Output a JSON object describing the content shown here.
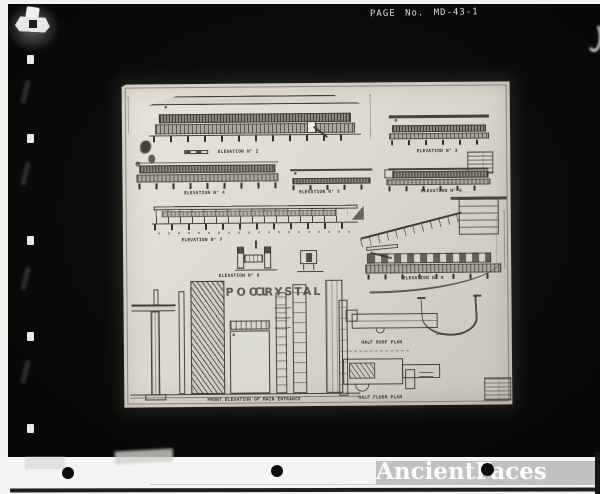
{
  "scan": {
    "handwritten_note": "PAGE No. MD-43-1",
    "watermark_text": "AncientFaces"
  },
  "sheet": {
    "sign_line1": "CRYSTAL",
    "sign_line2": "POOL",
    "labels": {
      "elevation2": "ELEVATION N° 2",
      "elevation3": "ELEVATION N° 3",
      "elevation4": "ELEVATION N° 4",
      "elevation5": "ELEVATION N° 5",
      "elevation6": "ELEVATION N° 6",
      "elevation7": "ELEVATION N° 7",
      "elevation8": "ELEVATION N° 8",
      "elevation9": "ELEVATION N° 9",
      "half_roof_plan": "HALF ROOF PLAN",
      "half_floor_plan": "HALF FLOOR PLAN",
      "entrance_caption": "FRONT ELEVATION OF MAIN ENTRANCE"
    }
  },
  "colors": {
    "film_black": "#0a0a09",
    "sheet_paper": "#dbd9d0",
    "ink": "#33312c",
    "watermark_bg": "#bdbdbd",
    "watermark_text": "#fdfdfd",
    "page_white": "#f2f2ef"
  }
}
